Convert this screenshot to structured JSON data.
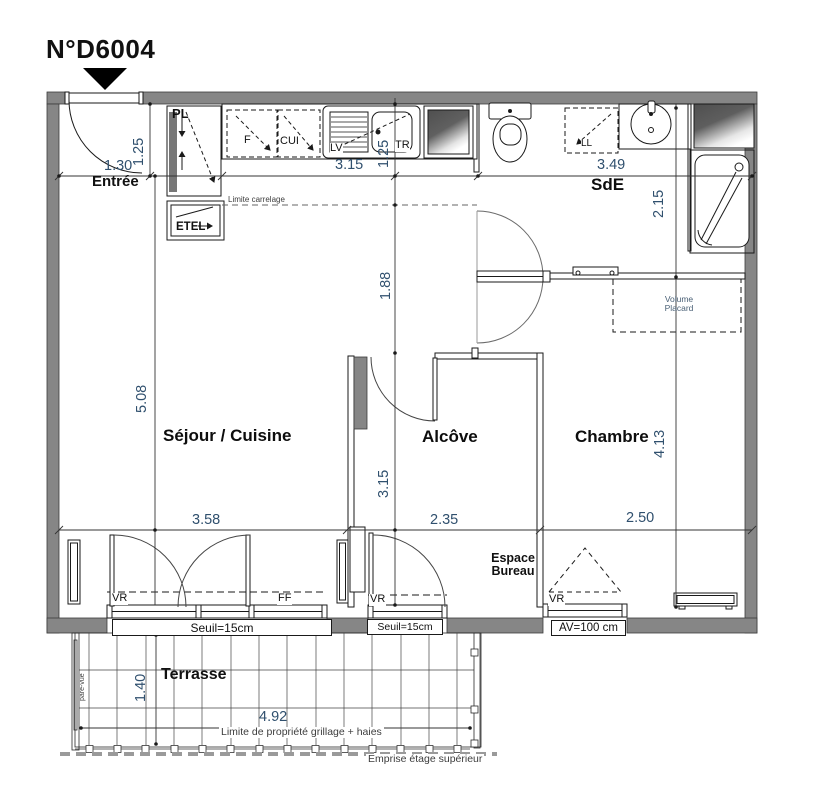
{
  "plan": {
    "title": "N°D6004",
    "rooms": {
      "entree": "Entrée",
      "sejour_cuisine": "Séjour / Cuisine",
      "alcove": "Alcôve",
      "chambre": "Chambre",
      "sde": "SdE",
      "terrasse": "Terrasse",
      "espace_bureau": "Espace Bureau"
    },
    "fixtures": {
      "pl": "PL",
      "etel": "ETEL",
      "frigo": "F",
      "cuisiniere": "CUI",
      "lave_vaisselle": "LV",
      "tri": "TR",
      "lave_linge": "LL",
      "volume_placard": "Volume Placard"
    },
    "windows": {
      "vr": "VR",
      "ff": "FF",
      "seuil": "Seuil=15cm",
      "av": "AV=100 cm"
    },
    "dimensions": {
      "entree_width": "1.30",
      "entree_depth": "1.25",
      "cuisine_width": "3.15",
      "cuisine_depth": "1.25",
      "sde_width": "3.49",
      "sde_depth": "2.15",
      "degagement_depth": "1.88",
      "sejour_depth": "5.08",
      "sejour_width": "3.58",
      "alcove_depth": "3.15",
      "alcove_width": "2.35",
      "chambre_depth": "4.13",
      "chambre_width": "2.50",
      "terrasse_depth": "1.40",
      "terrasse_width": "4.92"
    },
    "annotations": {
      "limite_carrelage": "Limite carrelage",
      "limite_propriete": "Limite de propriété grillage + haies",
      "emprise": "Emprise étage supérieur",
      "pare_vue": "pare-vue"
    },
    "colors": {
      "wall": "#868686",
      "dimension_text": "#30506e",
      "line": "#1a1a1a"
    }
  }
}
